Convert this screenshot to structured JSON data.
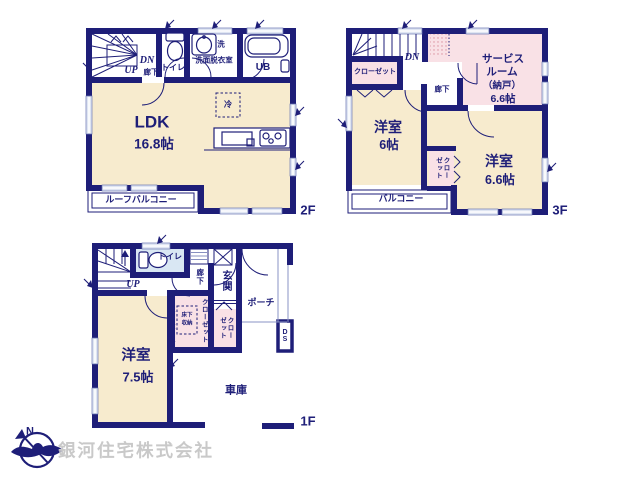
{
  "colors": {
    "wall": "#1e1e78",
    "room_cream": "#f7ebce",
    "room_pink": "#f9e1e6",
    "room_blue": "#d9e7f3",
    "window": "#dfe5f2",
    "watermark": "#c9c9c9"
  },
  "company": {
    "name": "銀河住宅株式会社"
  },
  "compass": {
    "north": "N"
  },
  "floors": {
    "f2": {
      "label": "2F",
      "stairs_up": "UP",
      "stairs_down": "DN",
      "hallway": "廊下",
      "toilet": "トイレ",
      "washroom": "洗面脱衣室",
      "washer": "洗",
      "bath": "UB",
      "fridge": "冷",
      "ldk": {
        "name": "LDK",
        "size": "16.8帖"
      },
      "balcony": "ルーフバルコニー"
    },
    "f3": {
      "label": "3F",
      "stairs_down": "DN",
      "closet": "クローゼット",
      "hallway": "廊下",
      "service_room": {
        "line1": "サービス",
        "line2": "ルーム",
        "line3": "（納戸）",
        "size": "6.6帖"
      },
      "bedroom1": {
        "name": "洋室",
        "size": "6帖"
      },
      "bedroom2": {
        "name": "洋室",
        "size": "6.6帖"
      },
      "closet2": {
        "col1": "クロー",
        "col2": "ゼット"
      },
      "balcony": "バルコニー"
    },
    "f1": {
      "label": "1F",
      "stairs_up": "UP",
      "toilet": "トイレ",
      "hallway": "廊下",
      "entrance": "玄関",
      "porch": "ポーチ",
      "closet1": "クローゼット",
      "underfloor": {
        "line1": "床下",
        "line2": "収納"
      },
      "closet2": {
        "col1": "クロー",
        "col2": "ゼット"
      },
      "duct": "DS",
      "bedroom": {
        "name": "洋室",
        "size": "7.5帖"
      },
      "garage": "車庫"
    }
  }
}
